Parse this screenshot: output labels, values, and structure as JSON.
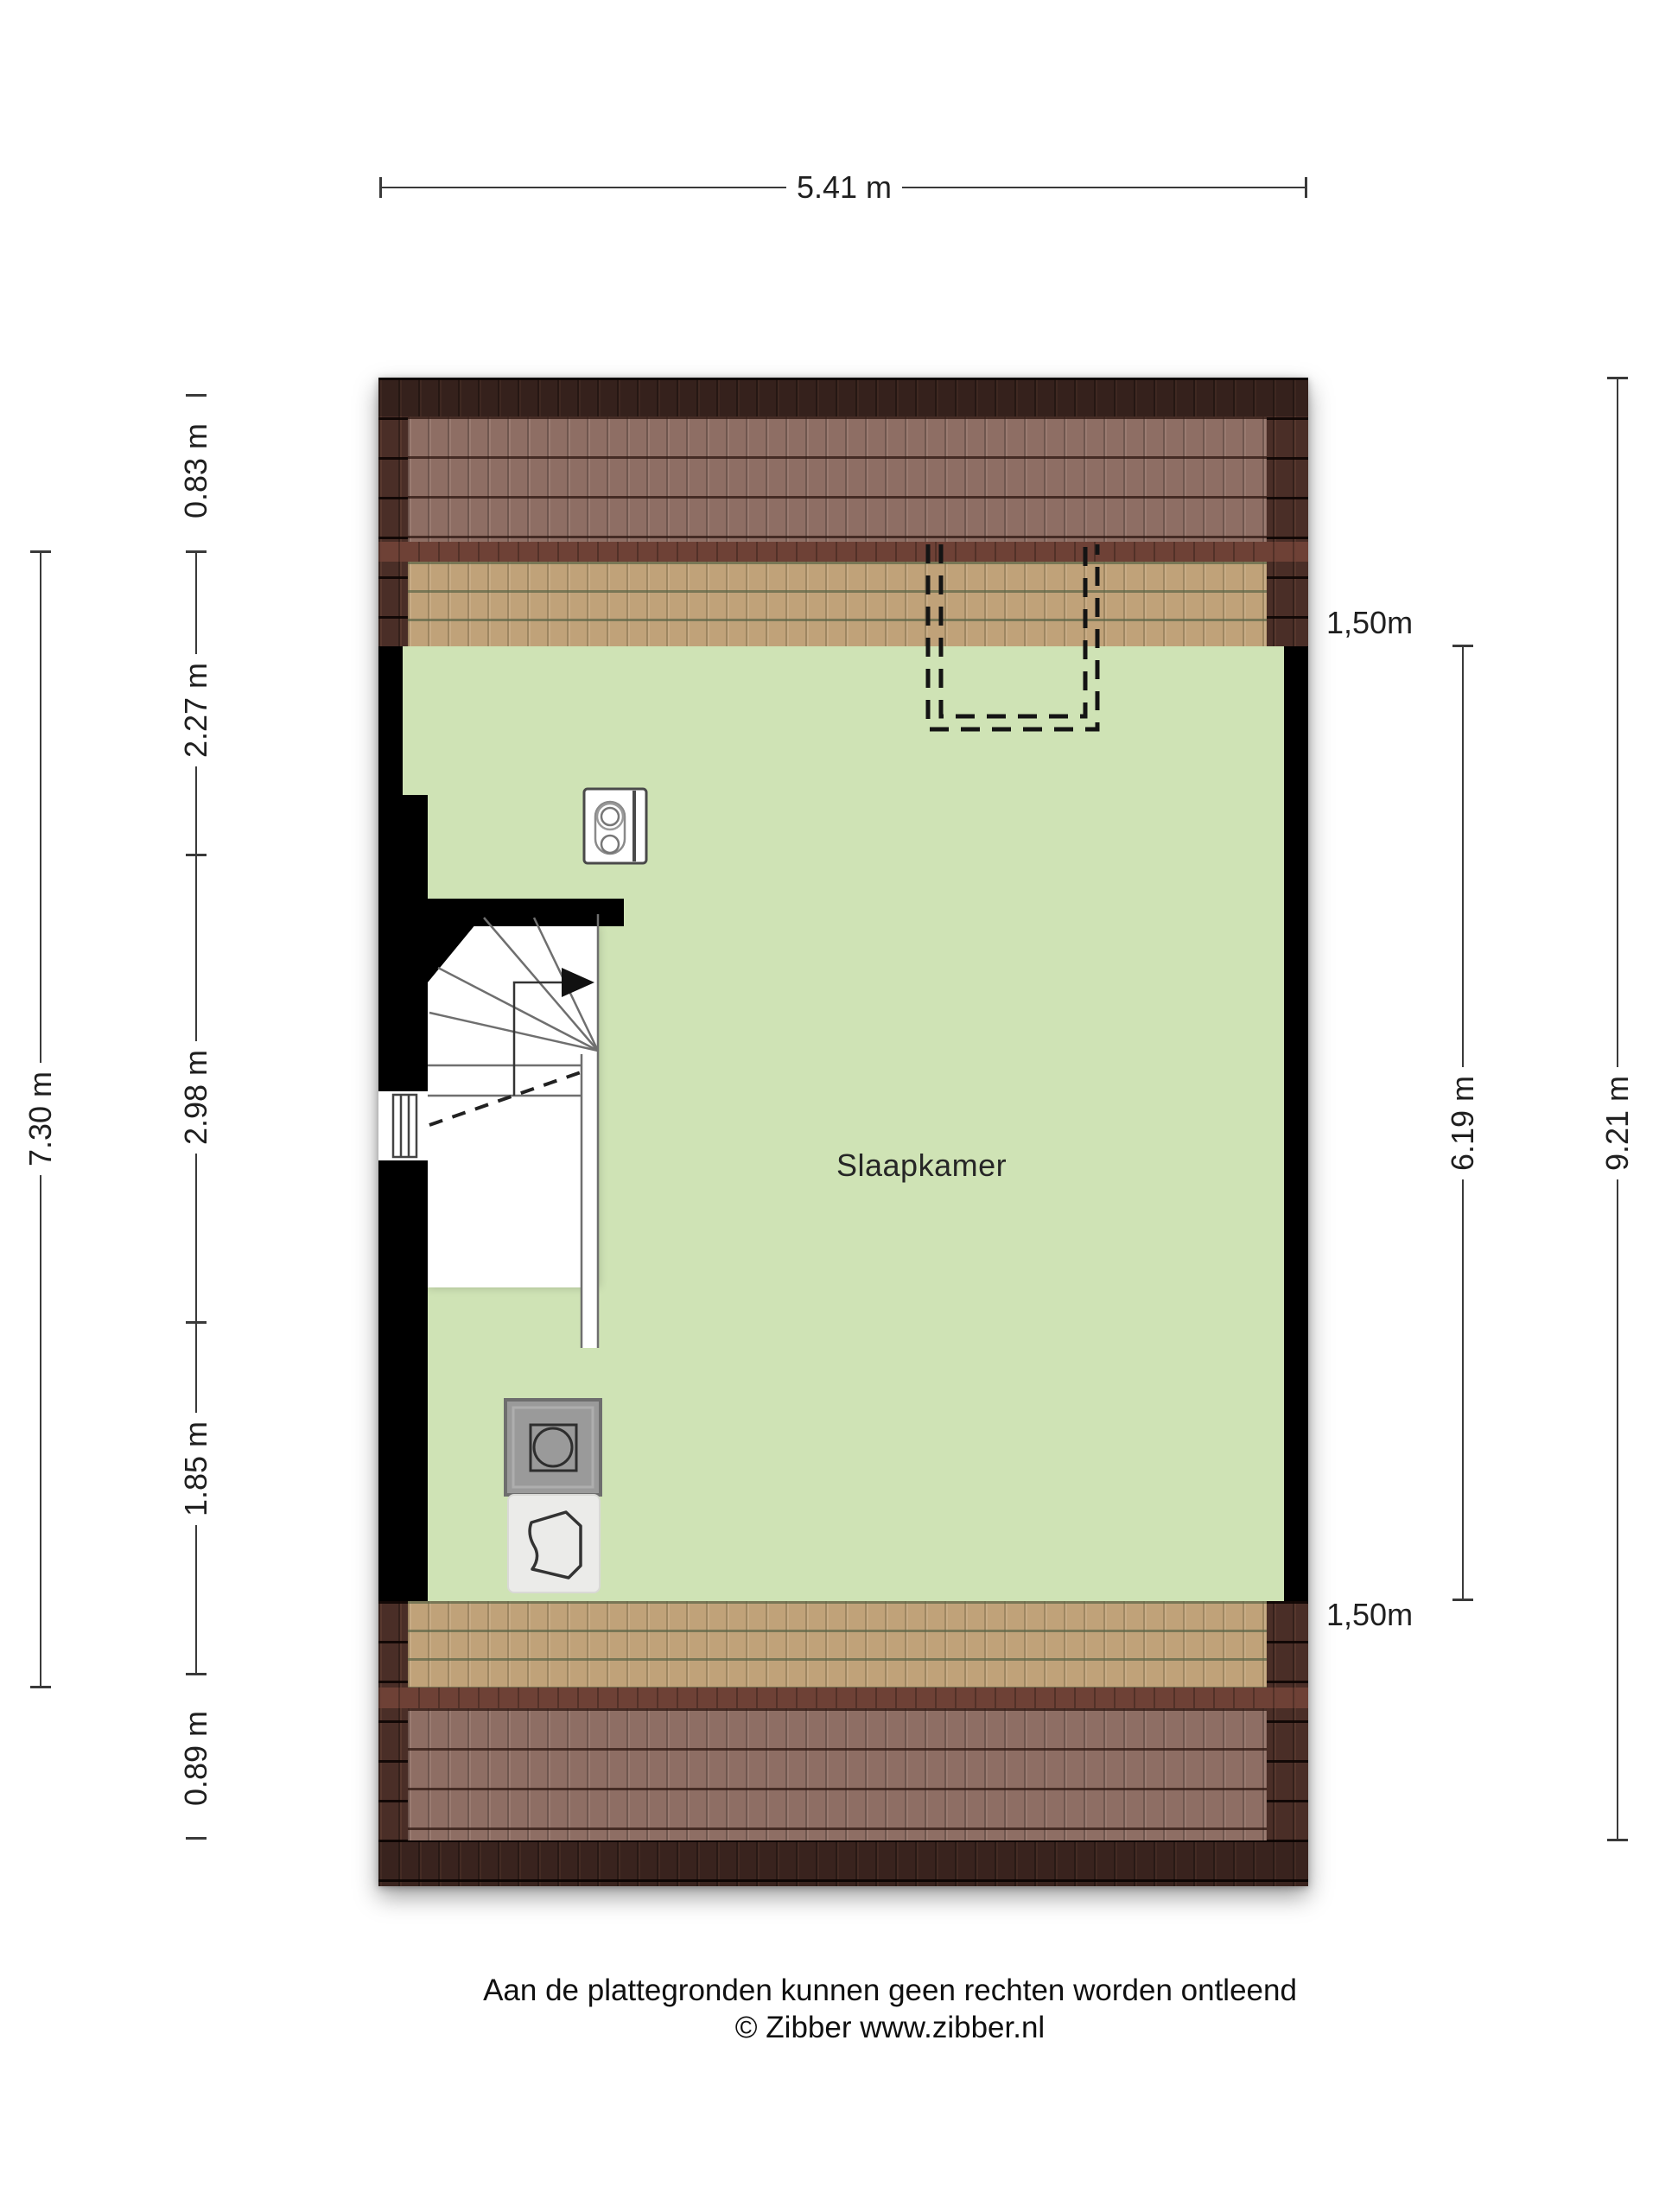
{
  "floorplan": {
    "room_label": "Slaapkamer",
    "dimensions": {
      "top_width": "5.41 m",
      "left_total": "7.30 m",
      "left_segments": [
        "0.83 m",
        "2.27 m",
        "2.98 m",
        "1.85 m",
        "0.89 m"
      ],
      "right_span": "6.19 m",
      "right_total": "9.21 m",
      "headroom_top": "1,50m",
      "headroom_bottom": "1,50m"
    },
    "fixtures": {
      "mv_unit": "mechanical-ventilation-unit",
      "washing_machine": "washing-machine",
      "laundry_basket": "laundry-basket",
      "dormer": "dormer-dashed-outline",
      "stairs": "winder-staircase"
    },
    "colors": {
      "floor_green": "#cfe3b5",
      "roof_dark": "#4a2e27",
      "roof_light_overlay": "#8e6e64",
      "roof_tan": "#c0a279",
      "roof_band": "#6e4136",
      "wall": "#000000"
    }
  },
  "footer": {
    "disclaimer": "Aan de plattegronden kunnen geen rechten worden ontleend",
    "copyright": "© Zibber www.zibber.nl"
  }
}
